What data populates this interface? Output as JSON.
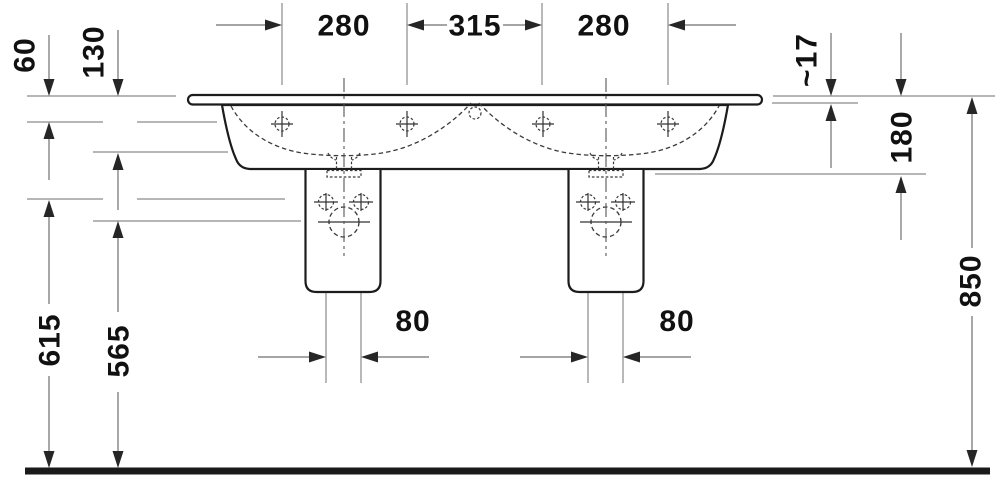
{
  "meta": {
    "type": "technical-dimension-drawing",
    "subject": "double washbasin with two siphon covers, front view"
  },
  "dimensions": {
    "top_left_280": "280",
    "top_middle_315": "315",
    "top_right_280": "280",
    "left_60": "60",
    "left_130": "130",
    "right_17": "~17",
    "right_180": "180",
    "right_850": "850",
    "lower_left_615": "615",
    "lower_left_565": "565",
    "pedestal_left_80": "80",
    "pedestal_right_80": "80"
  },
  "colors": {
    "background": "#ffffff",
    "object_outline": "#1c1c1c",
    "dimension_line": "#6f6f6f",
    "reference_line": "#8a8a8a",
    "hidden_detail": "#3a3a3a",
    "arrow": "#262626",
    "text": "#111111",
    "floor_line": "#1a1a1a"
  }
}
